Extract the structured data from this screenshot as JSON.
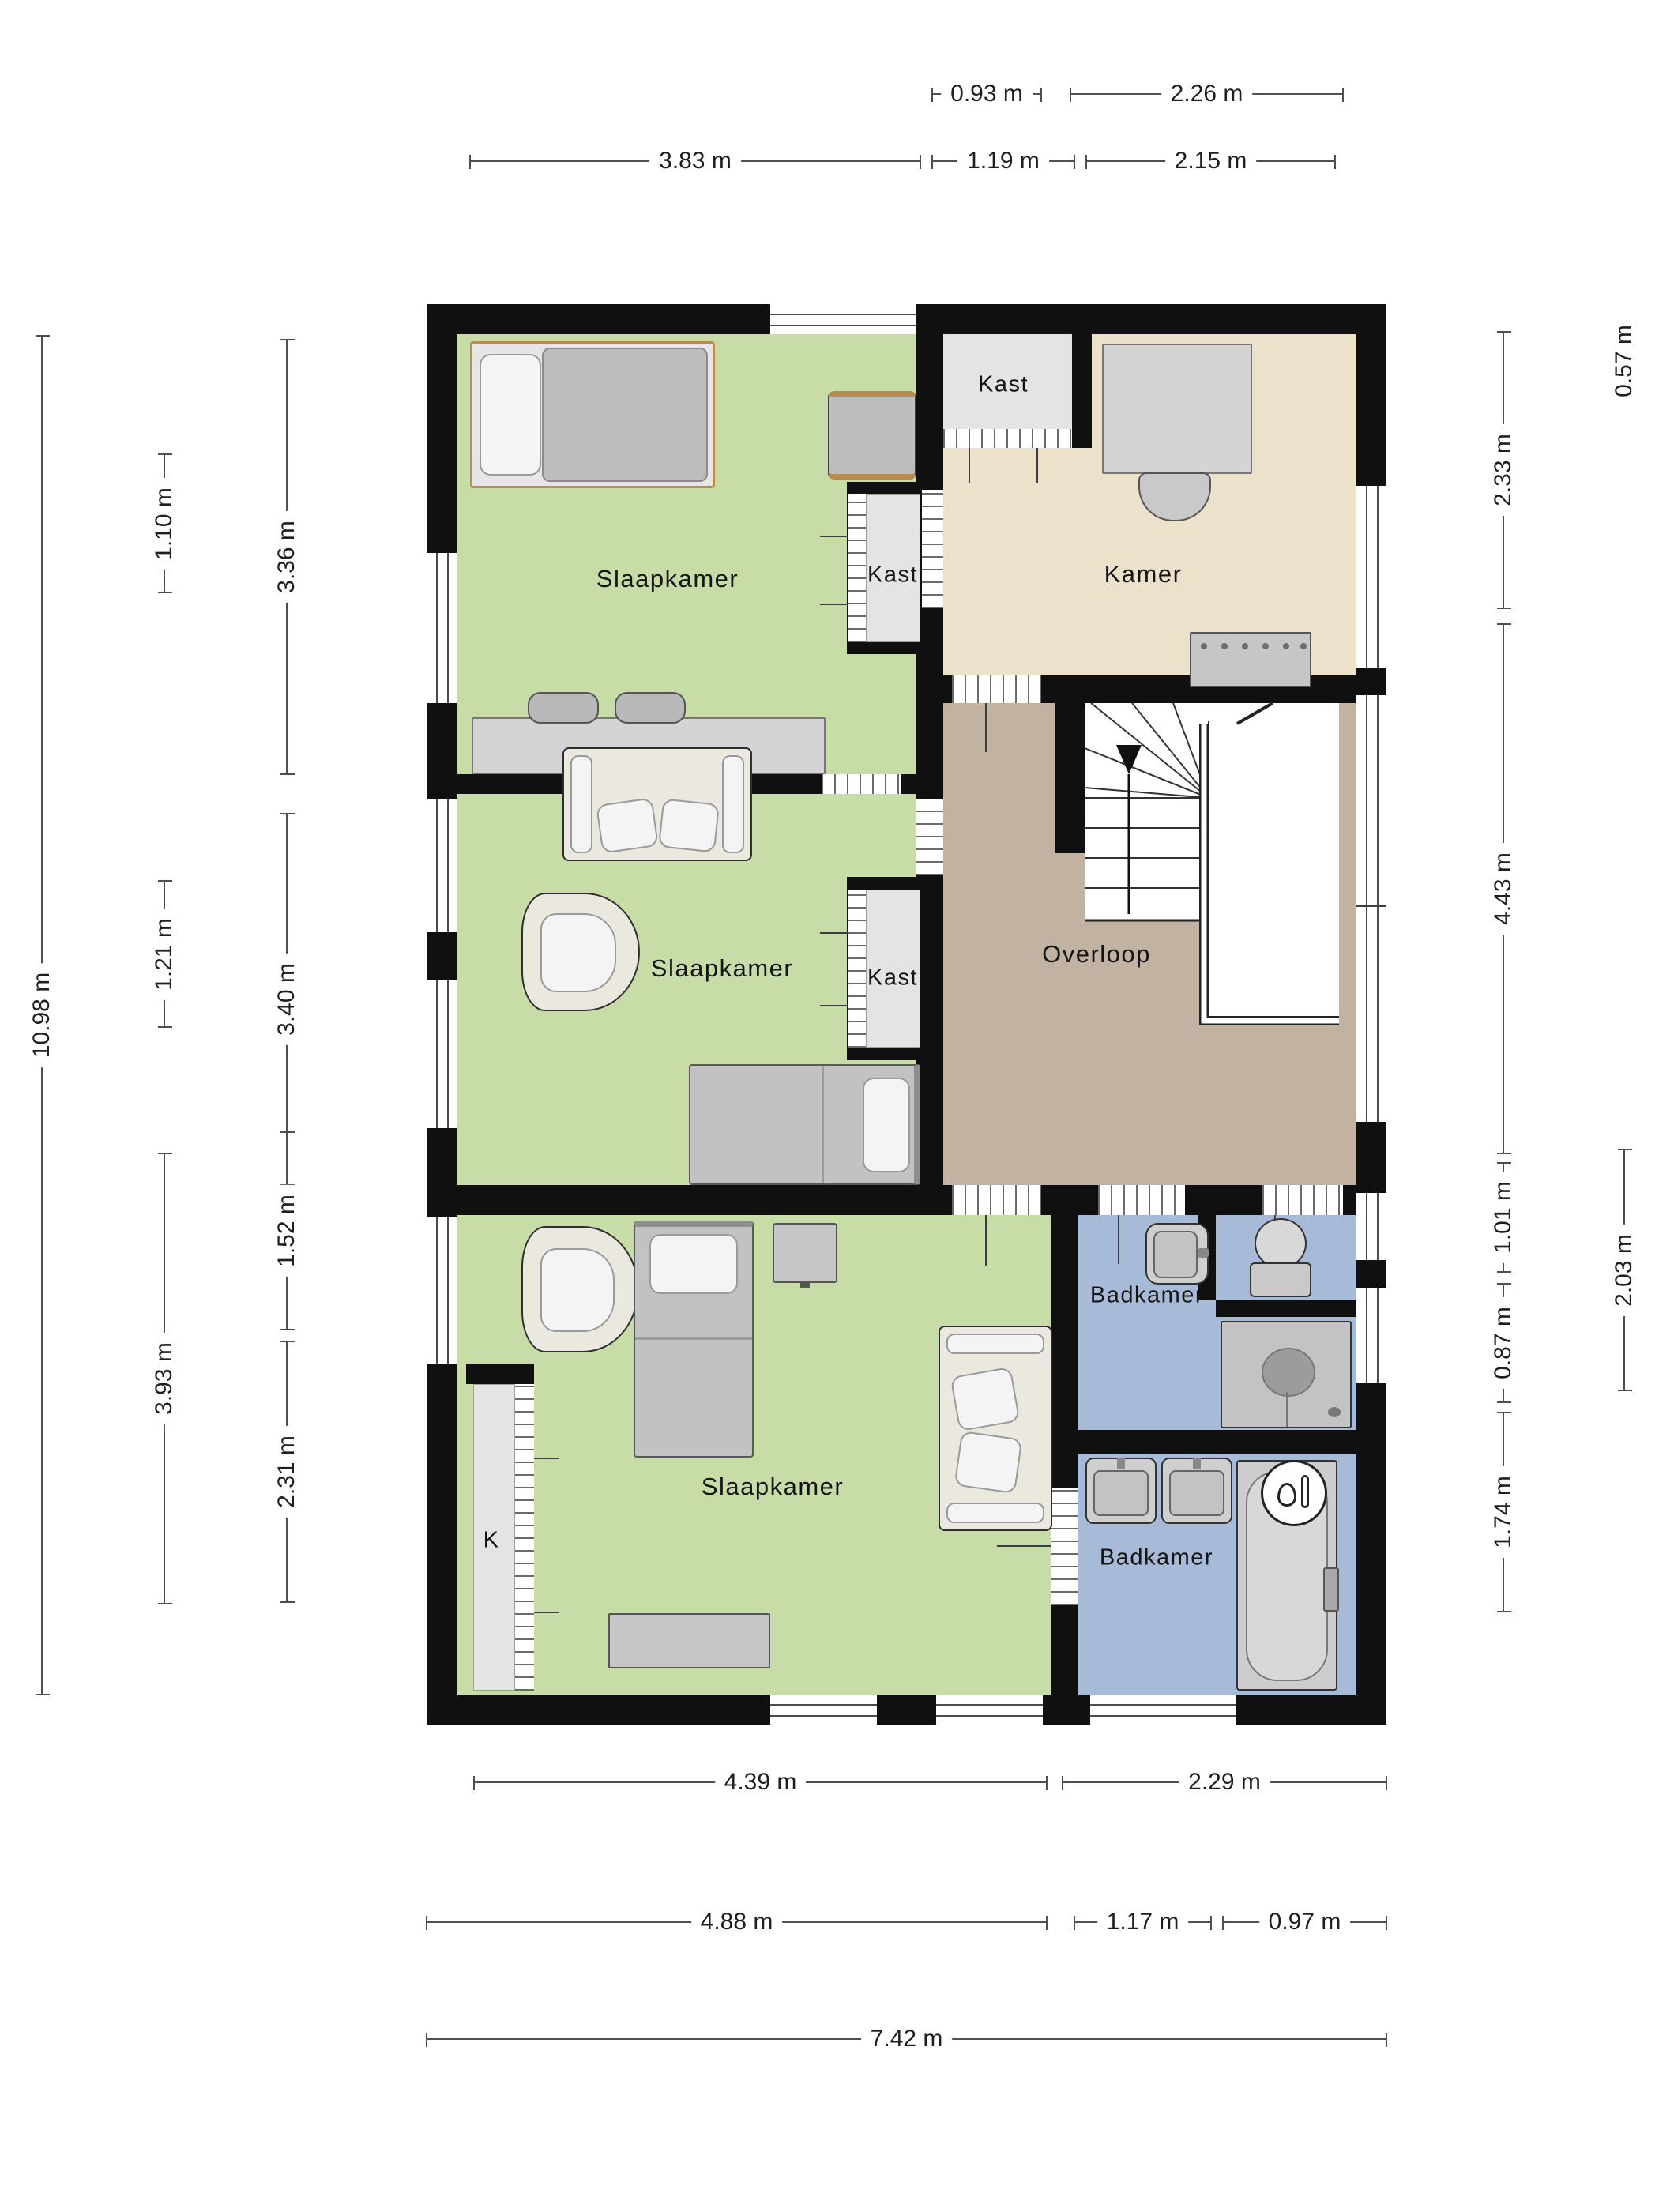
{
  "title": "Floor plan - first floor (verdieping)",
  "rooms": {
    "slaapkamer1": "Slaapkamer",
    "slaapkamer2": "Slaapkamer",
    "slaapkamer3": "Slaapkamer",
    "kast_top": "Kast",
    "kast1": "Kast",
    "kast2": "Kast",
    "kamer": "Kamer",
    "overloop": "Overloop",
    "badkamer1": "Badkamer",
    "badkamer2": "Badkamer",
    "k_closet": "K"
  },
  "dims": {
    "d093": "0.93 m",
    "d226": "2.26 m",
    "d383": "3.83 m",
    "d119": "1.19 m",
    "d215": "2.15 m",
    "d1098": "10.98 m",
    "d110": "1.10 m",
    "d121": "1.21 m",
    "d393": "3.93 m",
    "d336": "3.36 m",
    "d340": "3.40 m",
    "d152": "1.52 m",
    "d231": "2.31 m",
    "d057": "0.57 m",
    "d233": "2.33 m",
    "d443": "4.43 m",
    "d101": "1.01 m",
    "d087": "0.87 m",
    "d203": "2.03 m",
    "d174": "1.74 m",
    "d439": "4.39 m",
    "d229": "2.29 m",
    "d488": "4.88 m",
    "d117": "1.17 m",
    "d097": "0.97 m",
    "d742": "7.42 m"
  },
  "colors": {
    "wall": "#101010",
    "bedroom_green": "#c8dca8",
    "kamer_beige": "#ece2cb",
    "overloop_taupe": "#c2b2a2",
    "badkamer_blue": "#a7bad7",
    "closet_gray": "#e4e4e4",
    "furniture_gray": "#c9c9c9",
    "dimension_line": "#4f4f4f"
  }
}
